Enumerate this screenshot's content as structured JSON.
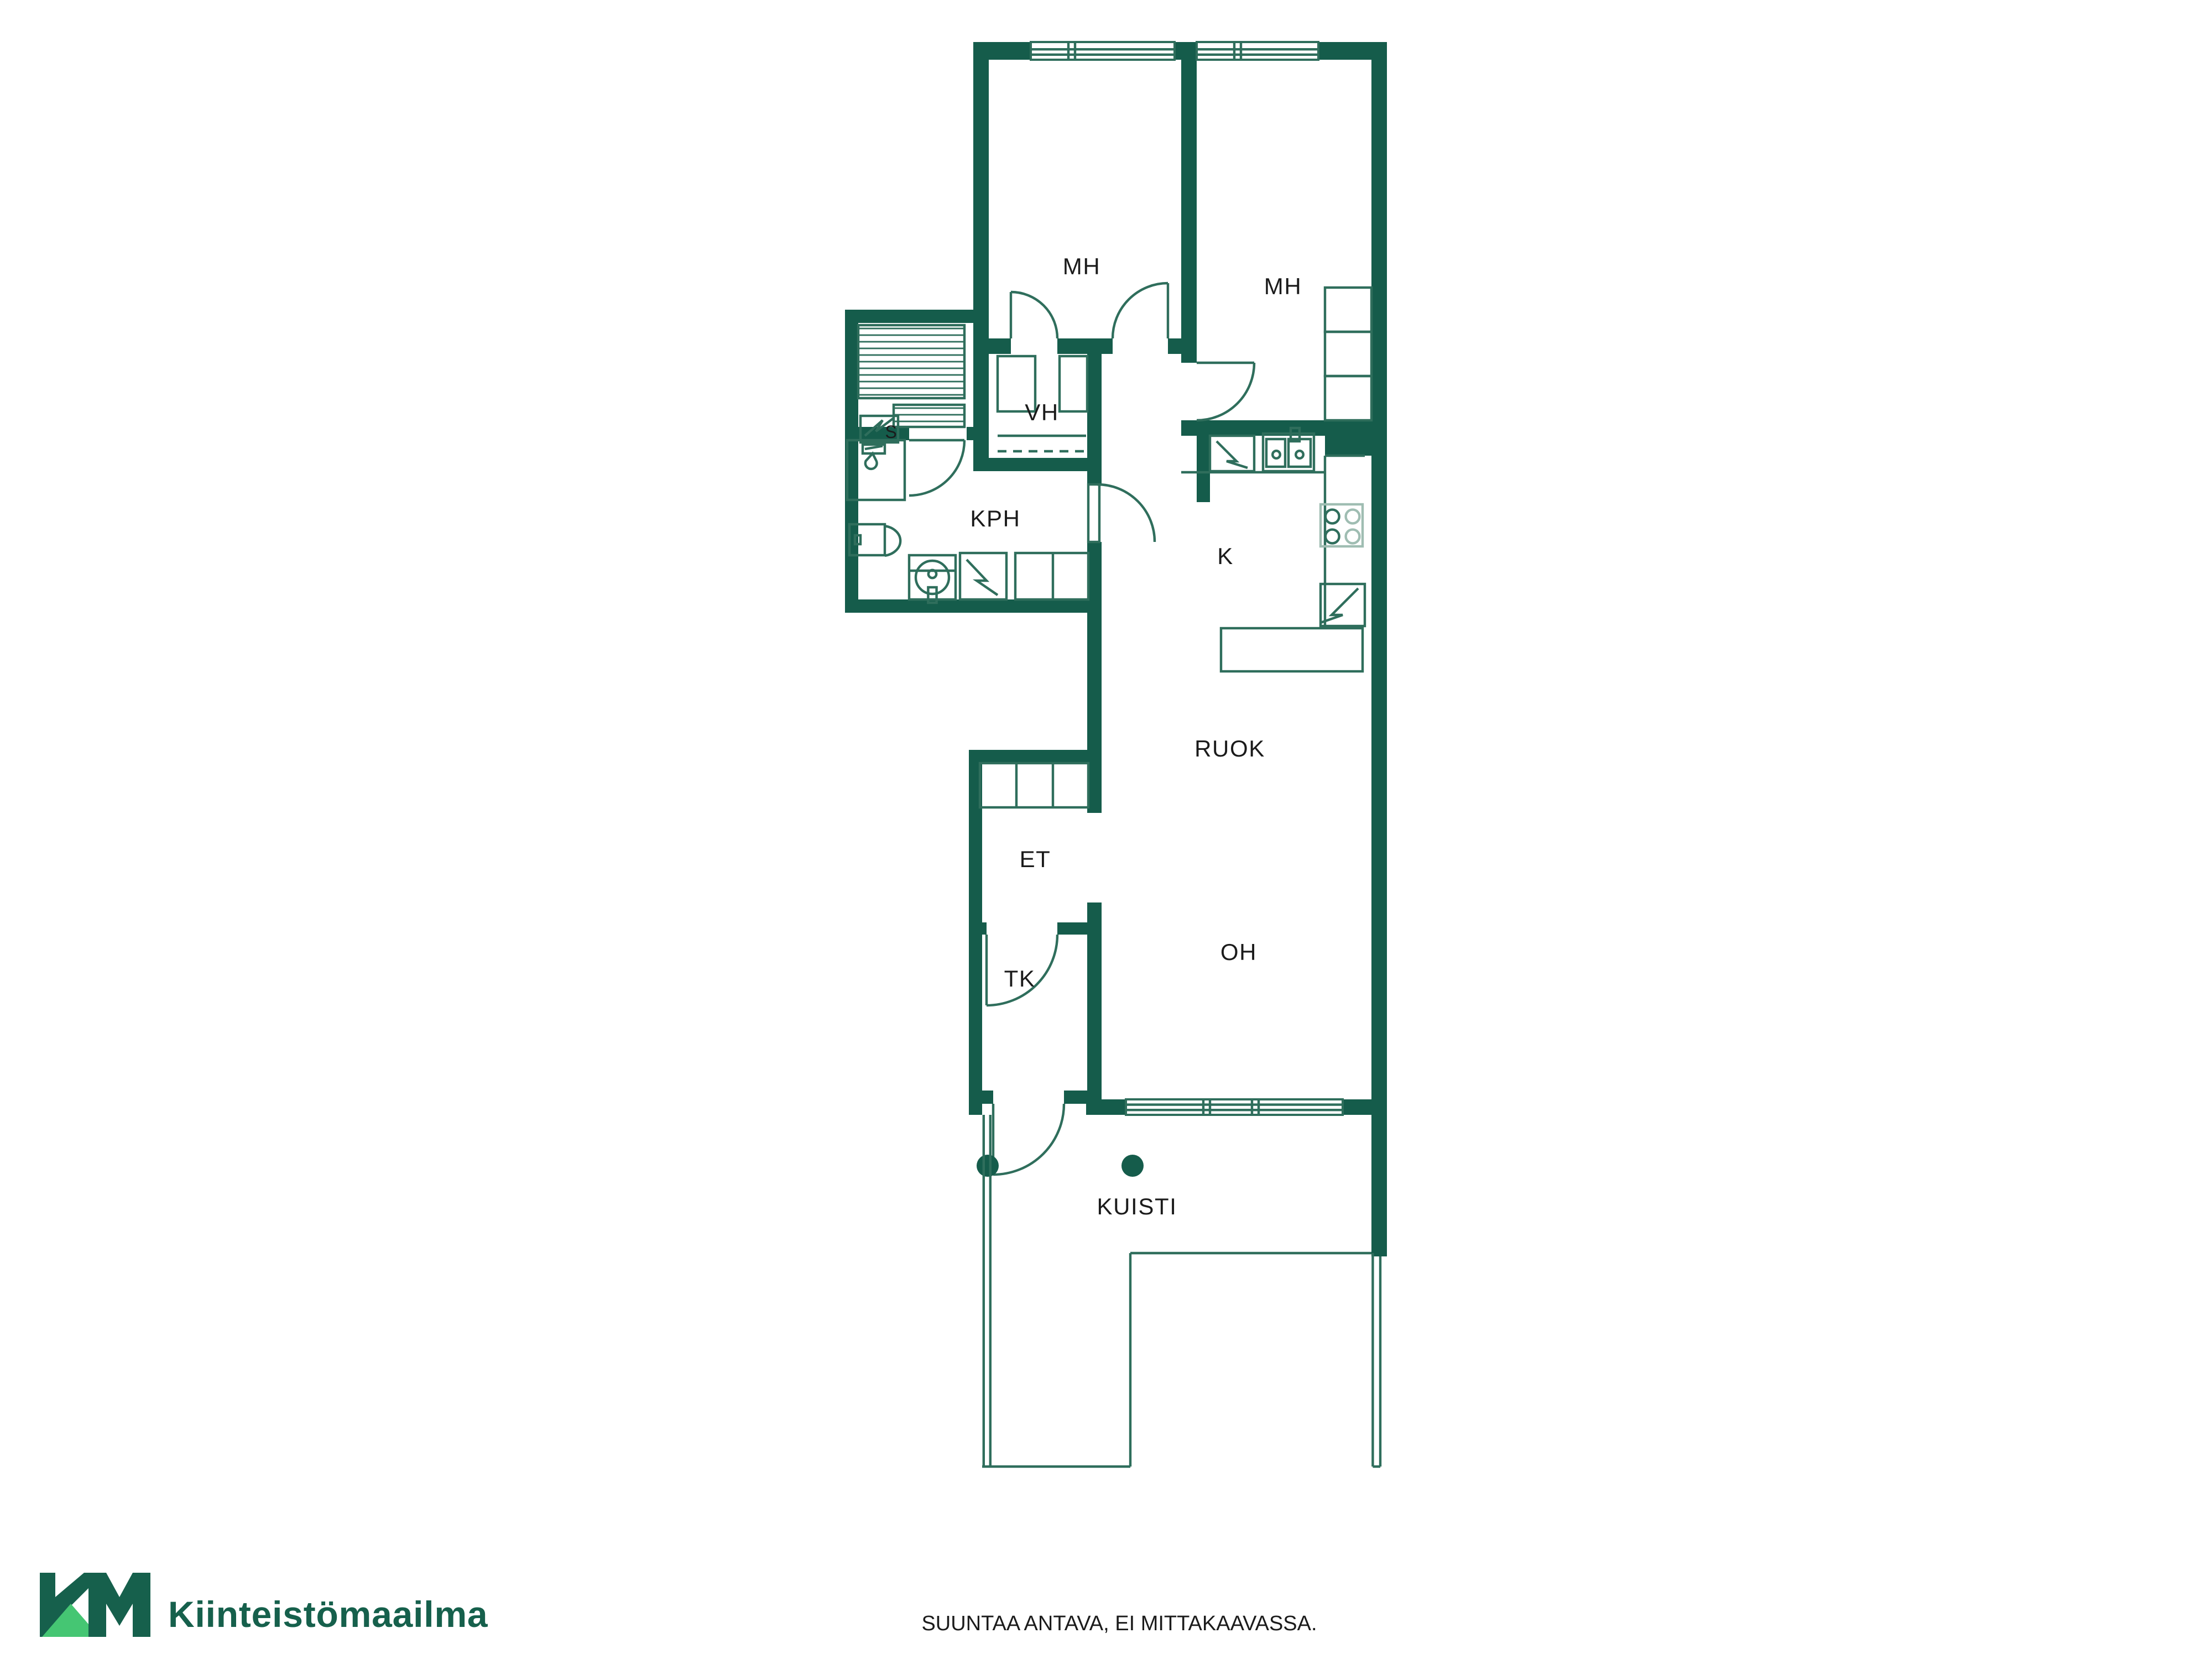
{
  "rooms": {
    "mh1": "MH",
    "mh2": "MH",
    "vh": "VH",
    "sauna": "S",
    "kph": "KPH",
    "kitchen": "K",
    "dining": "RUOK",
    "entry": "ET",
    "tk": "TK",
    "living": "OH",
    "porch": "KUISTI"
  },
  "branding": {
    "mark": "KM",
    "name": "Kiinteistömaailma"
  },
  "footer": {
    "disclaimer": "SUUNTAA ANTAVA, EI MITTAKAAVASSA."
  },
  "colors": {
    "wall": "#155C4B",
    "line": "#2F6E5C",
    "lineLight": "#9FBDB2",
    "text": "#1B1B1B",
    "logoDark": "#16604C",
    "logoLight": "#45C673",
    "bg": "#FFFFFF"
  }
}
